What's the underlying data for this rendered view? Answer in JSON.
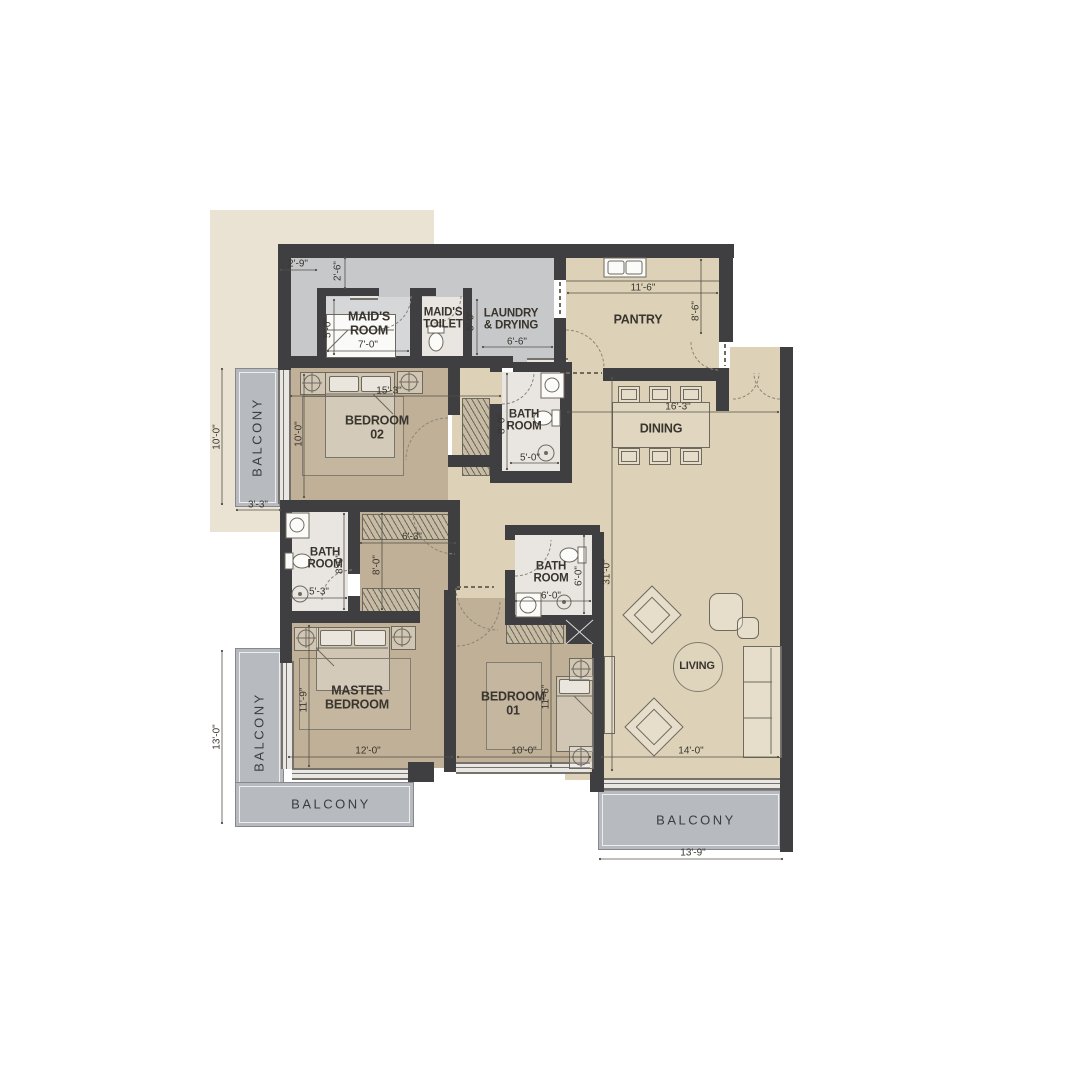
{
  "labels": {
    "maids_room": {
      "l1": "MAID'S",
      "l2": "ROOM"
    },
    "maids_toilet": {
      "l1": "MAID'S",
      "l2": "TOILET"
    },
    "laundry": {
      "l1": "LAUNDRY",
      "l2": "& DRYING"
    },
    "pantry": "PANTRY",
    "bedroom02": {
      "l1": "BEDROOM",
      "l2": "02"
    },
    "bath_room": {
      "l1": "BATH",
      "l2": "ROOM"
    },
    "dining": "DINING",
    "master_bedroom": {
      "l1": "MASTER",
      "l2": "BEDROOM"
    },
    "bedroom01": {
      "l1": "BEDROOM",
      "l2": "01"
    },
    "living": "LIVING",
    "balcony": "BALCONY"
  },
  "dimensions": {
    "top_offset_w": "2'-9\"",
    "top_offset_d": "2'-6\"",
    "maid_room_w": "7'-0\"",
    "maid_room_d": "5'-0\"",
    "laundry_w": "6'-6\"",
    "laundry_d": "5'-0\"",
    "pantry_w": "11'-6\"",
    "pantry_d": "8'-6\"",
    "bedroom02_w": "15'-3\"",
    "bedroom02_d": "10'-0\"",
    "bath1_d": "8'-0\"",
    "bath1_w": "5'-0\"",
    "dining_w": "16'-3\"",
    "balcony1_d": "10'-0\"",
    "balcony1_w": "3'-3\"",
    "dressing_w": "6'-3\"",
    "dressing_d": "8'-0\"",
    "master_bath_d": "8'-0\"",
    "master_bath_w": "5'-3\"",
    "bath2_w": "6'-0\"",
    "bath2_d": "6'-0\"",
    "master_w": "12'-0\"",
    "master_d": "11'-9\"",
    "bedroom01_w": "10'-0\"",
    "bedroom01_d": "11'-6\"",
    "living_w": "14'-0\"",
    "living_d": "31'-0\"",
    "balcony2_d": "13'-0\"",
    "balcony3_w": "13'-9\""
  },
  "colors": {
    "wall": "#3f3e40",
    "bedroom_floor": "#bfb097",
    "living_floor": "#ddd2b8",
    "service_floor": "#c7c8ca",
    "bath_floor": "#e9e6e2",
    "balcony_floor": "#b7bbc0",
    "backdrop": "#eae3d4"
  }
}
